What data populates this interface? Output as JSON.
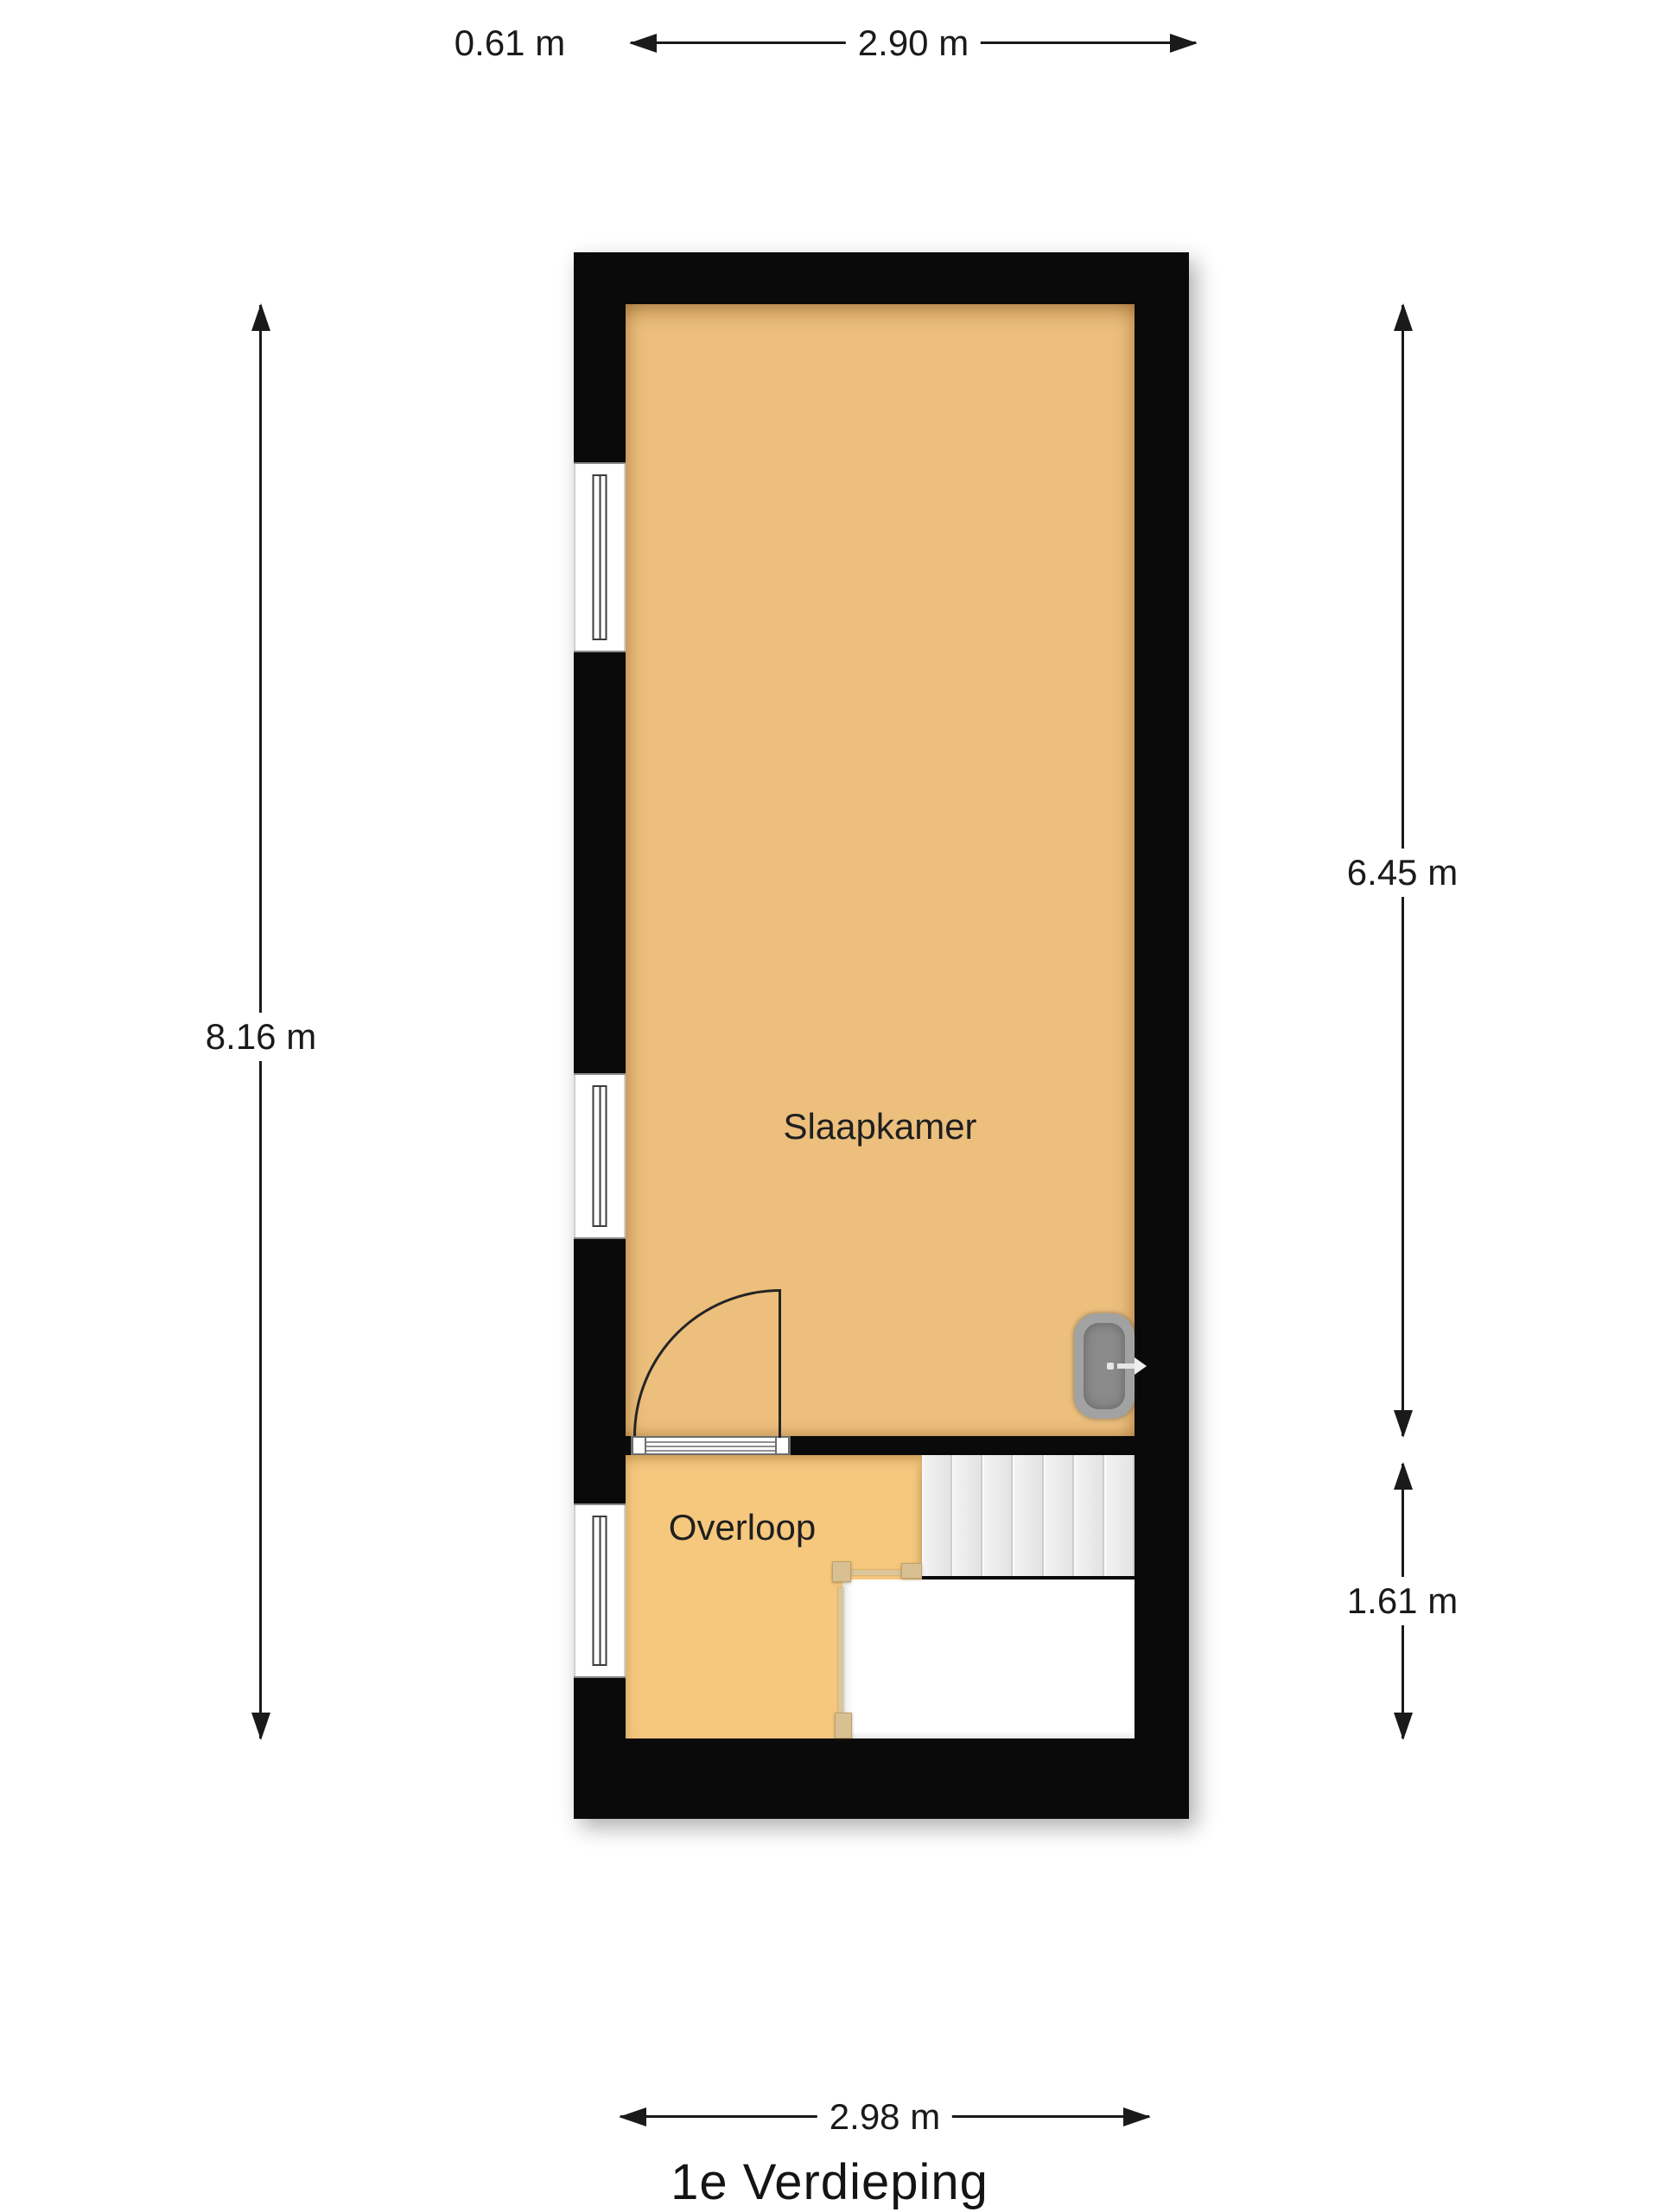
{
  "floor": {
    "title": "1e Verdieping"
  },
  "rooms": {
    "slaapkamer": {
      "label": "Slaapkamer"
    },
    "overloop": {
      "label": "Overloop"
    }
  },
  "dimensions": {
    "top_offset": "0.61 m",
    "top_width": "2.90 m",
    "left_height": "8.16 m",
    "right_upper_height": "6.45 m",
    "right_lower_height": "1.61 m",
    "bottom_width": "2.98 m"
  },
  "features": {
    "window_count": 3,
    "stair_tread_count": 7
  },
  "colors": {
    "background": "#ffffff",
    "wall": "#0a0a0a",
    "slaapkamer_floor": "#ecbf7d",
    "overloop_floor": "#f6c87e",
    "stair_tread": "#ebebeb",
    "stairwell_void": "#ffffff",
    "railing": "#dcc69b",
    "radiator": "#9b9b9b",
    "dimension_text": "#1a1a1a"
  }
}
